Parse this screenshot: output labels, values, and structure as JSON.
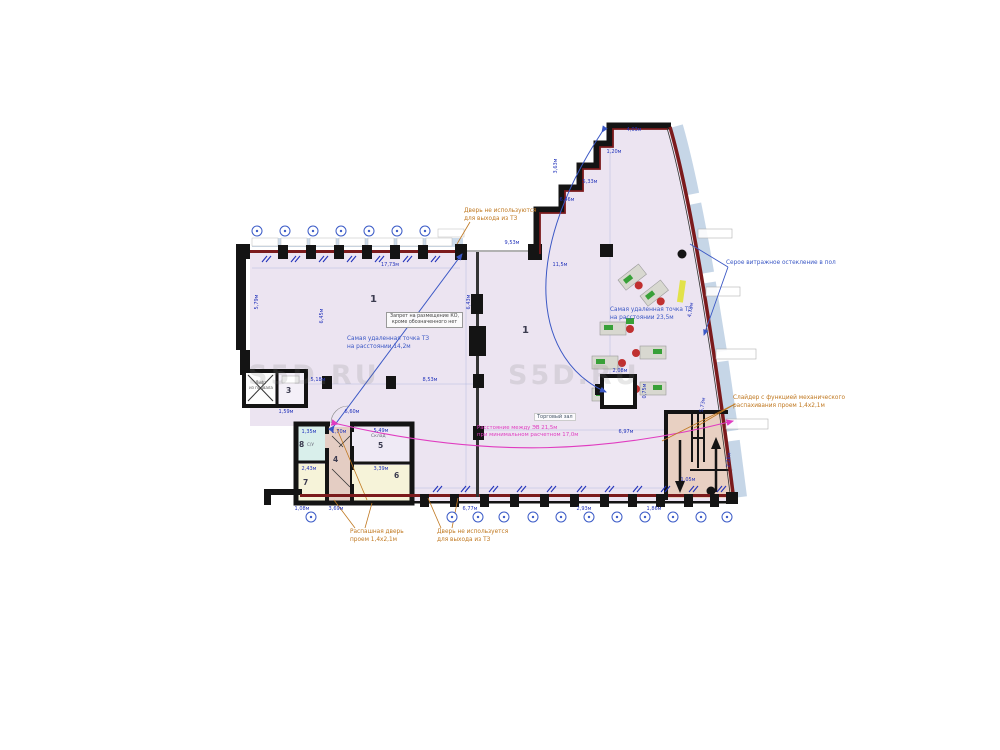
{
  "plan": {
    "colors": {
      "floor": "#ece4f1",
      "wall": "#141414",
      "facade_red": "#7b1a1c",
      "glazing_blue": "#c3d4e6",
      "annotation_blue": "#3a57c5",
      "annotation_orange": "#c07820",
      "annotation_magenta": "#e03cc0",
      "dimension_blue": "#2233bb",
      "stairs_tan": "#e8d0c2",
      "corridor_tan": "#e4cdc3",
      "room_yellow": "#f6f3d9",
      "room_cyan": "#d9efeb",
      "room_lavender": "#efeaf5"
    },
    "watermark": "S5D.RU",
    "rooms": {
      "hall_left": "1",
      "hall_right": "1",
      "r3": "3",
      "r4": "4",
      "r5": "5",
      "r5_name": "Склад",
      "r6": "6",
      "r7": "7",
      "r8": "8",
      "r8_name": "С/У",
      "lift": "Лифт\nиз подвала",
      "hall_name": "Торговый зал"
    },
    "annotations": {
      "door_top": "Дверь не используются\nдля выхода из ТЗ",
      "door_bottom": "Дверь не используется\nдля выхода из ТЗ",
      "swing_door": "Распашная дверь\nпроем 1,4х2,1м",
      "slider": "Слайдер с функцией механического\nраспахивания проем 1,4х2,1м",
      "far_point_left": "Самая удаленная точка ТЗ\nна расстоянии 14,2м",
      "far_point_right": "Самая удаленная точка ТЗ\nна расстоянии 23,5м",
      "glazing": "Серое витражное остекление в пол",
      "ban": "Запрет на размещение КО,\nкроме обозначенного нет",
      "distance_ev": "Расстояние между ЭВ 21,5м\nпри минимальном расчетном 17,0м"
    },
    "dims": [
      {
        "t": "17,73м",
        "x": 390,
        "y": 265,
        "r": 0
      },
      {
        "t": "5,79м",
        "x": 257,
        "y": 302,
        "r": -90
      },
      {
        "t": "6,45м",
        "x": 322,
        "y": 316,
        "r": -90
      },
      {
        "t": "6,43м",
        "x": 469,
        "y": 302,
        "r": -90
      },
      {
        "t": "11,5м",
        "x": 560,
        "y": 265,
        "r": 0
      },
      {
        "t": "9,53м",
        "x": 512,
        "y": 243,
        "r": 0
      },
      {
        "t": "5,33м",
        "x": 590,
        "y": 182,
        "r": 0
      },
      {
        "t": "4,03м",
        "x": 634,
        "y": 130,
        "r": 0
      },
      {
        "t": "3,63м",
        "x": 556,
        "y": 166,
        "r": -90
      },
      {
        "t": "6,46м",
        "x": 567,
        "y": 200,
        "r": 0
      },
      {
        "t": "1,20м",
        "x": 614,
        "y": 152,
        "r": 0
      },
      {
        "t": "8,53м",
        "x": 430,
        "y": 380,
        "r": 0
      },
      {
        "t": "5,18м",
        "x": 318,
        "y": 380,
        "r": 0
      },
      {
        "t": "6,60м",
        "x": 352,
        "y": 412,
        "r": 0
      },
      {
        "t": "1,59м",
        "x": 286,
        "y": 412,
        "r": 0
      },
      {
        "t": "4,73м",
        "x": 691,
        "y": 310,
        "r": -80
      },
      {
        "t": "5,73м",
        "x": 703,
        "y": 405,
        "r": -80
      },
      {
        "t": "6,97м",
        "x": 626,
        "y": 432,
        "r": 0
      },
      {
        "t": "1,70м",
        "x": 339,
        "y": 432,
        "r": 0
      },
      {
        "t": "5,49м",
        "x": 381,
        "y": 431,
        "r": 0
      },
      {
        "t": "3,39м",
        "x": 381,
        "y": 469,
        "r": 0
      },
      {
        "t": "2,43м",
        "x": 309,
        "y": 469,
        "r": 0
      },
      {
        "t": "1,35м",
        "x": 309,
        "y": 432,
        "r": 0
      },
      {
        "t": "1,05м",
        "x": 688,
        "y": 480,
        "r": 0
      },
      {
        "t": "2,28м",
        "x": 729,
        "y": 460,
        "r": -85
      },
      {
        "t": "2,08м",
        "x": 620,
        "y": 371,
        "r": 0
      },
      {
        "t": "0,75м",
        "x": 645,
        "y": 391,
        "r": -90
      },
      {
        "t": "1,08м",
        "x": 302,
        "y": 509,
        "r": 0
      },
      {
        "t": "3,69м",
        "x": 336,
        "y": 509,
        "r": 0
      },
      {
        "t": "6,77м",
        "x": 470,
        "y": 509,
        "r": 0
      },
      {
        "t": "2,93м",
        "x": 584,
        "y": 509,
        "r": 0
      },
      {
        "t": "1,86м",
        "x": 654,
        "y": 509,
        "r": 0
      }
    ],
    "markers": {
      "top": {
        "y": 231,
        "xs": [
          257,
          285,
          313,
          341,
          369,
          397,
          425
        ]
      },
      "bottom": {
        "y": 517,
        "xs": [
          311,
          452,
          478,
          504,
          533,
          561,
          589,
          617,
          645,
          673,
          701,
          727
        ]
      }
    },
    "ticks": {
      "top": {
        "y": 262,
        "xs": [
          262,
          291,
          319,
          347,
          375,
          403,
          431
        ]
      },
      "bottom": {
        "y": 492,
        "xs": [
          433,
          461,
          489,
          517,
          547,
          577,
          605,
          633,
          661,
          689,
          717
        ]
      }
    }
  }
}
